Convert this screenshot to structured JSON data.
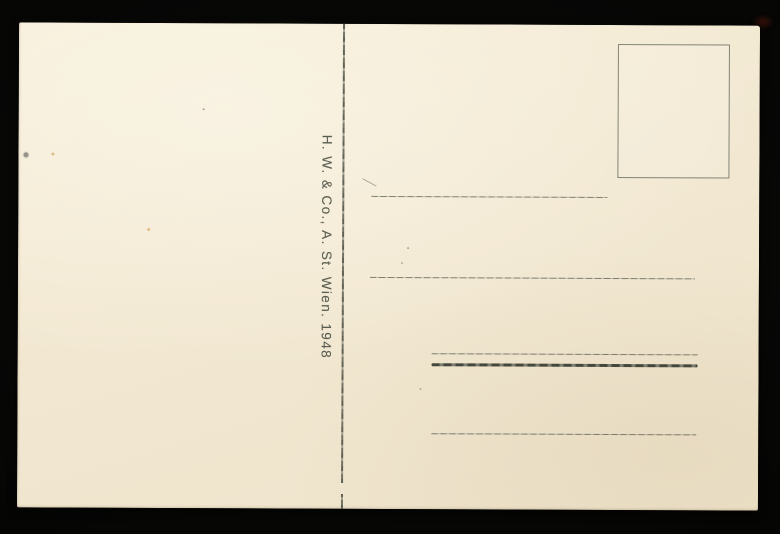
{
  "scene": {
    "description": "Scanned back of a blank vintage postcard lying on a black background",
    "background_color": "#070706",
    "card_color": "#f2e8d2",
    "ink_color": "#5b5e51",
    "rule_color": "#5c5e52",
    "heavy_rule_color": "#3a3f34"
  },
  "postcard": {
    "imprint": {
      "text": "H. W. & Co., A. St. Wien. 1948"
    },
    "stamp_box": {
      "present": true
    },
    "divider_present": true,
    "address_lines": [
      {
        "x": 353,
        "y": 172,
        "w": 236,
        "weight": "thin"
      },
      {
        "x": 352,
        "y": 253,
        "w": 325,
        "weight": "thin"
      },
      {
        "x": 414,
        "y": 329,
        "w": 266,
        "weight": "thin"
      },
      {
        "x": 414,
        "y": 339,
        "w": 266,
        "weight": "heavy"
      },
      {
        "x": 414,
        "y": 409,
        "w": 265,
        "weight": "thin"
      }
    ]
  }
}
